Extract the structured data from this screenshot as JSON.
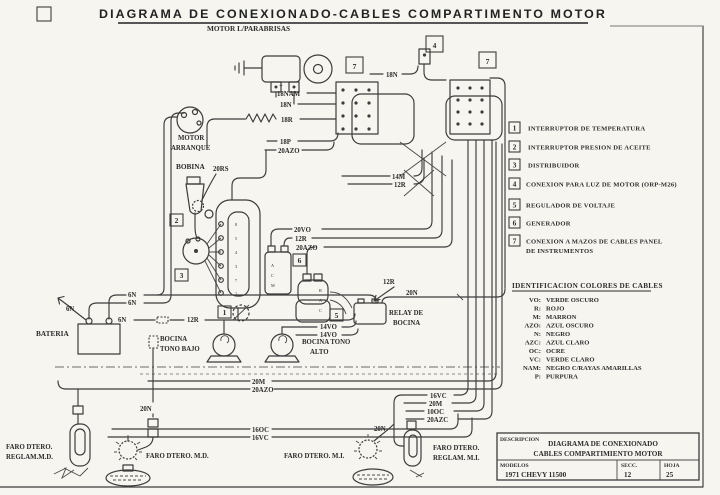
{
  "sheet": {
    "title": "DIAGRAMA DE CONEXIONADO-CABLES COMPARTIMENTO MOTOR",
    "ink_color": "#3c3c3c",
    "paper_color": "#f6f5f0"
  },
  "legend": {
    "items": [
      {
        "num": "1",
        "label": "INTERRUPTOR DE TEMPERATURA"
      },
      {
        "num": "2",
        "label": "INTERRUPTOR PRESION DE ACEITE"
      },
      {
        "num": "3",
        "label": "DISTRIBUIDOR"
      },
      {
        "num": "4",
        "label": "CONEXION PARA LUZ DE MOTOR (ORP-M26)"
      },
      {
        "num": "5",
        "label": "REGULADOR DE VOLTAJE"
      },
      {
        "num": "6",
        "label": "GENERADOR"
      },
      {
        "num": "7",
        "label": "CONEXION A MAZOS DE CABLES PANEL",
        "label2": "DE INSTRUMENTOS"
      }
    ]
  },
  "colors": {
    "heading": "IDENTIFICACION COLORES DE CABLES",
    "items": [
      {
        "code": "VO:",
        "name": "VERDE OSCURO"
      },
      {
        "code": "R:",
        "name": "ROJO"
      },
      {
        "code": "M:",
        "name": "MARRON"
      },
      {
        "code": "AZO:",
        "name": "AZUL OSCURO"
      },
      {
        "code": "N:",
        "name": "NEGRO"
      },
      {
        "code": "AZC:",
        "name": "AZUL CLARO"
      },
      {
        "code": "OC:",
        "name": "OCRE"
      },
      {
        "code": "VC:",
        "name": "VERDE CLARO"
      },
      {
        "code": "NAM:",
        "name": "NEGRO C/RAYAS AMARILLAS"
      },
      {
        "code": "P:",
        "name": "PURPURA"
      }
    ]
  },
  "title_block": {
    "descripcion_label": "DESCRIPCION",
    "descripcion_line1": "DIAGRAMA DE CONEXIONADO",
    "descripcion_line2": "CABLES COMPARTIMIENTO MOTOR",
    "modelos_label": "MODELOS",
    "modelos_value": "1971  CHEVY  11500",
    "secc_label": "SECC.",
    "secc_value": "12",
    "hoja_label": "HOJA",
    "hoja_value": "25"
  },
  "labels": {
    "motor_parabrisas": "MOTOR L/PARABRISAS",
    "motor": "MOTOR",
    "arranque": "ARRANQUE",
    "bobina": "BOBINA",
    "bateria": "BATERIA",
    "bocina": "BOCINA",
    "tono_bajo": "TONO BAJO",
    "bocina_tono": "BOCINA TONO",
    "alto": "ALTO",
    "relay_1": "RELAY DE",
    "relay_2": "BOCINA",
    "faro_dtero": "FARO DTERO.",
    "reglam_md": "REGLAM.M.D.",
    "faro_md": "FARO DTERO. M.D.",
    "faro_mi": "FARO DTERO. M.I.",
    "reglam_mi": "REGLAM. M.I."
  },
  "wires": {
    "plus": "+",
    "nam18": "18NAM",
    "n18": "18N",
    "r18": "18R",
    "p18": "18P",
    "azo20": "20AZO",
    "rs20": "20RS",
    "m14": "14M",
    "r12": "12R",
    "vo20": "20VO",
    "n6": "6N",
    "n20": "20N",
    "vo14": "14VO",
    "m20": "20M",
    "oc16": "16OC",
    "vc16": "16VC",
    "oc10": "10OC",
    "azc20": "20AZC"
  },
  "engine": {
    "terminals": [
      "8",
      "5",
      "4",
      "3",
      "7",
      "1"
    ]
  },
  "gen": {
    "t1": "B",
    "t2": "A",
    "t3": "C"
  },
  "reg": {
    "t1": "A",
    "t2": "C",
    "t3": "M"
  }
}
